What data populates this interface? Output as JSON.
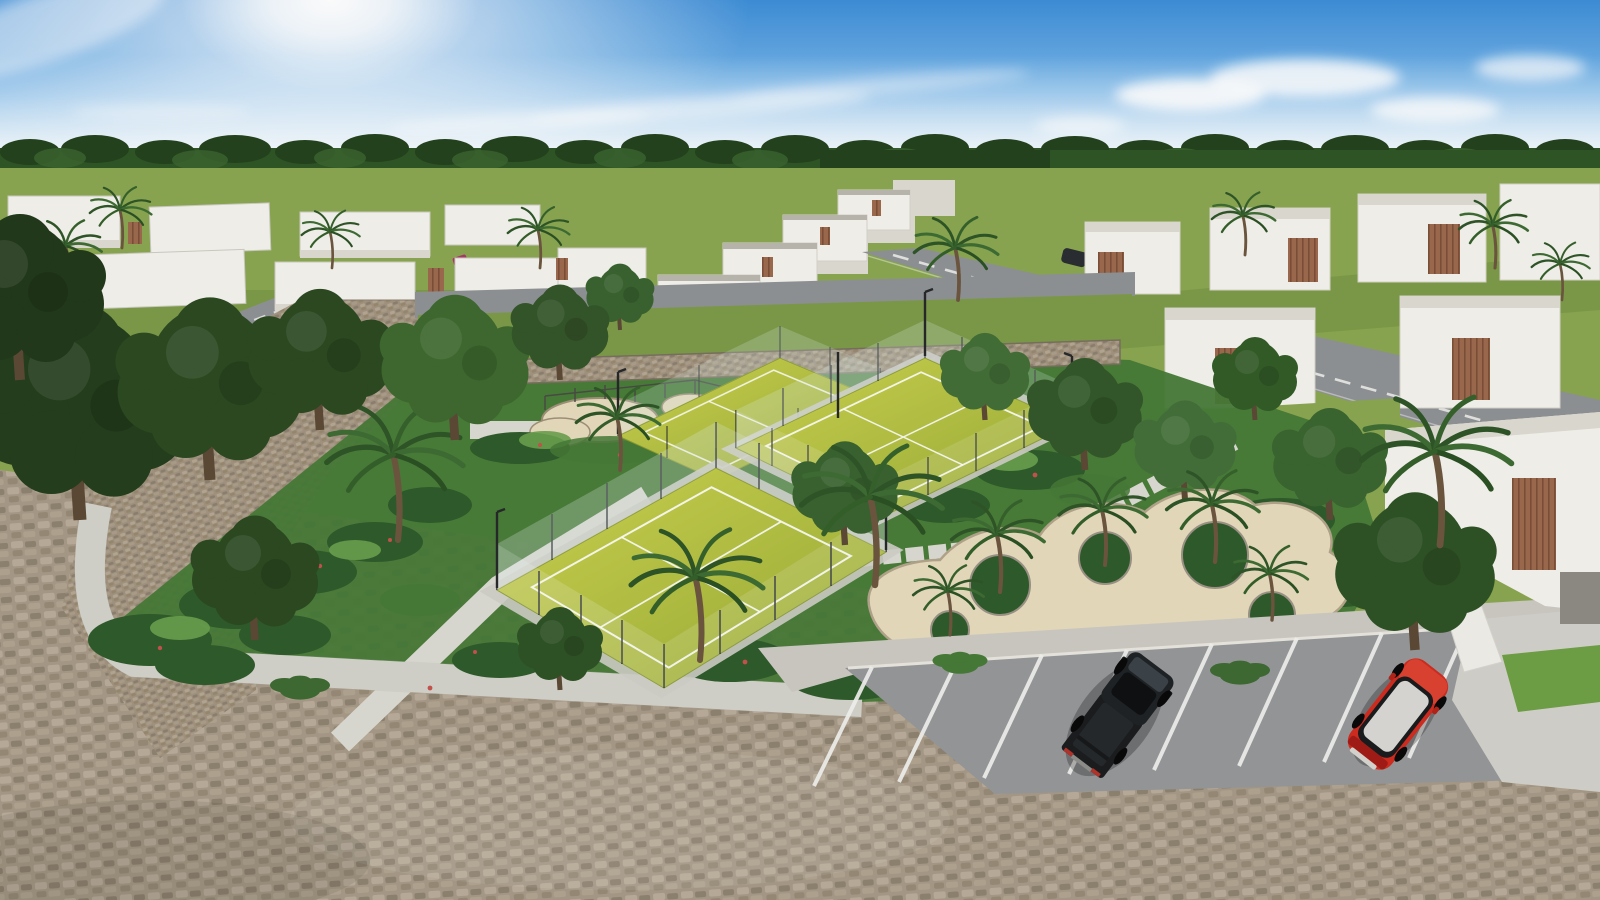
{
  "scene": {
    "kind": "aerial-architectural-render",
    "time_of_day": "sunny-day"
  },
  "palette": {
    "sky_top": "#3e8ed8",
    "sky_mid": "#7cb9ea",
    "sky_horizon": "#d9edf9",
    "sun_glow": "#ffffff",
    "forest_dark": "#24431d",
    "forest_mid": "#2f5526",
    "forest_light": "#3c6530",
    "lawn": "#8aa751",
    "lawn_olive": "#7d9b49",
    "lawn_bright": "#6fa045",
    "house_white": "#f3f2ec",
    "house_shade": "#dddbd2",
    "house_dark": "#c7c5bc",
    "wood_accent": "#9c6a4e",
    "wood_dark": "#7c4f38",
    "street_gray": "#8f9294",
    "street_line": "#f2f2ef",
    "court_turf": "#b4bf41",
    "court_turf_light": "#ccd44f",
    "court_turf_dark": "#9aab38",
    "court_line": "#ffffff",
    "court_frame": "#cfcec6",
    "glass_tint": "#dcebe6",
    "post_dark": "#2e3133",
    "garden_dark": "#2f5b2b",
    "garden_mid": "#477a38",
    "garden_light": "#6aa04e",
    "flower_red": "#c4534d",
    "sand": "#e7dbbd",
    "sand_rim": "#b2a58b",
    "path_concrete": "#dcdbd3",
    "apron_concrete": "#cbc9c2",
    "asphalt": "#96979a",
    "cobble_base": "#a79a87",
    "cobble_light": "#b9ac99",
    "cobble_dark": "#8e8270",
    "truck_black": "#1b1d1f",
    "suv_red": "#d12c20",
    "suv_red_dark": "#a21d16",
    "suv_roof": "#d9d8d4",
    "trunk_brown": "#6d5640"
  },
  "objects": {
    "vehicles": [
      {
        "name": "pickup-truck",
        "color": "black",
        "location": "parking-lot"
      },
      {
        "name": "suv",
        "color": "red",
        "roof": "white",
        "location": "parking-lot"
      },
      {
        "name": "parked-car",
        "color": "dark-gray",
        "location": "street-right"
      },
      {
        "name": "parked-car-small",
        "color": "magenta",
        "location": "street-left"
      }
    ],
    "amenities": [
      "padel-courts",
      "playground-sand-pits",
      "sand-plaza-with-palm-islands",
      "tropical-gardens",
      "concrete-walkways",
      "parking-lot",
      "gabion-stone-wall"
    ],
    "counts": {
      "padel_courts": 3,
      "plaza_islands": 5,
      "parking_stripes": 9
    }
  }
}
